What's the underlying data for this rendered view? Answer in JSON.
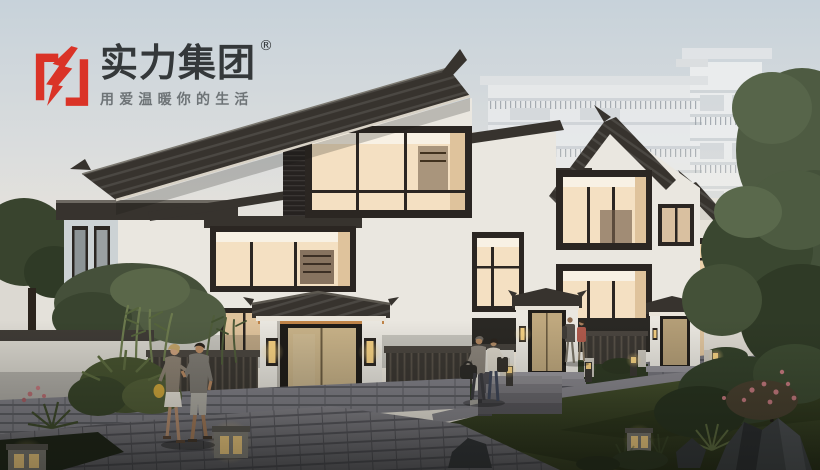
{
  "meta": {
    "width": 820,
    "height": 470,
    "alt": "Dusk architectural rendering of Chinese-style courtyard villas with warmly lit corner windows, entrance gates with tiled canopies, fences, lawn and stone path, residents strolling, a faded high-rise tower and trees in the background"
  },
  "logo": {
    "icon": "lightning-brackets-icon",
    "brand_name": "实力集团",
    "registered_mark": "®",
    "tagline": "用爱温暖你的生活"
  },
  "palette": {
    "brand_red": "#da3327",
    "logo_text": "#34383a",
    "tagline_text": "#6e7477",
    "sky_top": "#c7d2da",
    "sky_horizon": "#efe9e0",
    "highrise_white": "#e9ebec",
    "wall_white": "#eae7e0",
    "wall_shadow": "#ccd2d4",
    "roof_dark": "#37332e",
    "frame_dark": "#2b2622",
    "window_glow": "#f4e0c2",
    "window_glow_deep": "#dfc39c",
    "window_ceiling": "#f8f1e4",
    "door_tan": "#c8b288",
    "fence_dark": "#3b3732",
    "lawn_light": "#4b5731",
    "lawn_dark": "#242b15",
    "path_light": "#8f8d94",
    "path_dark": "#5a595f",
    "stone_base": "#80808a",
    "tree_green": "#47543a",
    "tree_dark": "#2e3a26",
    "lamp_glow": "#f5cf82"
  },
  "scene": {
    "elements": [
      "dusk sky",
      "faded high-rise apartment tower",
      "three chinese-style villas with lit corner bay windows",
      "entrance gates with grey tiled canopies, tan doors, lanterns and stone lions",
      "dark wooden slat fences and white courtyard walls",
      "stone masonry base wall and paved pathway",
      "evening lawn with rocks, shrubs, bamboo and flowering bushes",
      "glowing stone cube garden lamps",
      "three couples of residents walking"
    ]
  }
}
